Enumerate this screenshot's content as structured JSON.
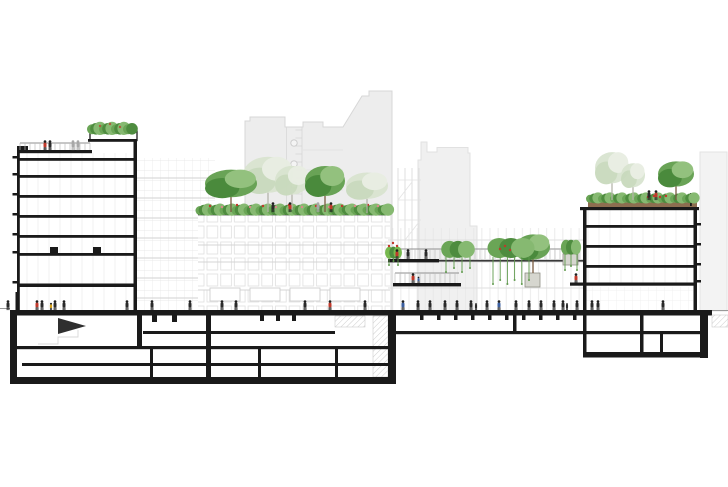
{
  "colors": {
    "ink": "#1a1a1a",
    "ground_line": "#9a9a9a",
    "sil_fill": "#ededed",
    "sil_edge": "#d7d7d7",
    "sil_fill2": "#f0f0f0",
    "tree_mid": "#69a356",
    "tree_dark": "#4a8a3c",
    "tree_light": "#93c17e",
    "faint_mid": "#d9e4d0",
    "faint_dark": "#c9dabd",
    "faint_light": "#e8eee2",
    "trunk": "#7a5a40",
    "trunk_faint": "#b3b3a8",
    "shrub1": "#6aa556",
    "shrub2": "#4e8c3f",
    "shrub3": "#86b971",
    "bright": "#76b94e",
    "soil": "#8d6e50",
    "soil_dark": "#5f4632",
    "red": "#c0392b",
    "pink": "#d98a8a",
    "rust": "#b05a3c",
    "person_dark": "#2a2a2a",
    "person_gray": "#a8a8a8",
    "blue": "#3b5fa0",
    "yellow": "#d4a017",
    "pot": "#d6d6cf",
    "pot_edge": "#8f8f85",
    "rail": "#bcbcbc",
    "rail_dark": "#8f8f8f",
    "grid_dark": "#d2d2d2",
    "vine": "#5f9a4c"
  },
  "silhouettes": {
    "central": {
      "points": "245,311 245,121 250,121 250,117 285,117 285,127 303,127 303,122 323,122 323,127 343,127 362,96 369,96 369,91 392,91 392,311",
      "verticals": [
        286.5,
        302
      ],
      "ladder_x": [
        295.5,
        302
      ],
      "ladder_y1": 130,
      "ladder_y2": 196,
      "ladder_step": 8,
      "circles": {
        "cx": 294,
        "cys": [
          143,
          164,
          185
        ],
        "r": 3.2
      },
      "hlines": {
        "x1": 303,
        "x2": 343,
        "ys": [
          150,
          170,
          190
        ]
      }
    },
    "rightbg": {
      "points": "418,311 418,160 421,160 421,142 427,142 427,152 437,152 437,147.5 468,147.5 468,153 470,153 470,226 477,226 477,311"
    },
    "farright": {
      "points": "700,311 700,152 727,152 727,311"
    },
    "trellis": {
      "verticals": [
        398,
        405,
        412,
        419
      ],
      "y1": 168,
      "y2": 262,
      "hlines": [
        180,
        200,
        220,
        240
      ],
      "hx1": 398,
      "hx2": 421,
      "diagonals": [
        [
          398,
          200,
          412,
          182
        ],
        [
          405,
          240,
          419,
          222
        ]
      ]
    }
  },
  "back_facade": {
    "rect": [
      137,
      158,
      78,
      153
    ],
    "floor_ys": [
      178,
      198,
      218,
      238,
      258,
      278,
      298
    ]
  },
  "podium": {
    "deck": [
      198,
      212.5,
      192,
      2.8
    ],
    "facade": [
      198,
      214,
      192,
      97
    ],
    "floor_lines": [
      245,
      262,
      290
    ],
    "storefronts": [
      [
        210,
        288,
        30,
        13
      ],
      [
        250,
        288,
        30,
        13
      ],
      [
        290,
        288,
        30,
        13
      ],
      [
        330,
        288,
        30,
        13
      ]
    ]
  },
  "colonnade": {
    "rect": [
      388,
      228,
      195,
      82
    ],
    "lines": [
      240,
      262,
      288
    ]
  },
  "decks": {
    "a_black": [
      388,
      259,
      51,
      3.4
    ],
    "a_thin": [
      439,
      259.8,
      144,
      1.8
    ],
    "a_rail": [
      390,
      580,
      249,
      259
    ],
    "b_black": [
      393,
      283,
      68,
      3.4
    ],
    "b_rail": [
      395,
      459,
      273,
      283
    ]
  },
  "left_building": {
    "wallL": [
      17,
      150,
      2.8,
      160
    ],
    "wallR": [
      133.5,
      140,
      3.5,
      170
    ],
    "roof_slab": [
      17,
      150,
      75,
      3.2
    ],
    "parapet": [
      17,
      146,
      11,
      4
    ],
    "interior": [
      19,
      153,
      114.5,
      157
    ],
    "floors": [
      [
        19,
        158,
        115,
        2.8
      ],
      [
        19,
        175,
        115,
        2.8
      ],
      [
        19,
        195,
        115,
        2.8
      ],
      [
        19,
        215,
        115,
        2.8
      ],
      [
        19,
        235,
        115,
        2.8
      ],
      [
        19,
        253,
        115,
        2.8
      ],
      [
        19,
        283.5,
        115,
        3.5
      ]
    ],
    "ticks_y": [
      156,
      173,
      193,
      213,
      233,
      251,
      281
    ],
    "planter_box": [
      90,
      131,
      47,
      9.5
    ],
    "planter_slab": [
      88,
      139,
      49,
      2.8
    ],
    "doors": [
      [
        50,
        247,
        8,
        6
      ],
      [
        93,
        247,
        8,
        6
      ]
    ],
    "roof_rail": [
      20,
      90,
      143,
      150
    ]
  },
  "right_building": {
    "wallL": [
      583,
      207,
      3.5,
      103
    ],
    "wallR": [
      693.5,
      207,
      3.5,
      103
    ],
    "roof_slab": [
      580,
      207,
      119,
      3.2
    ],
    "soil": [
      588,
      200,
      109,
      7
    ],
    "rail_post": [
      690,
      193,
      1.8,
      13
    ],
    "interior": [
      586,
      210,
      107,
      73
    ],
    "ground_floor": [
      586,
      287,
      107,
      23
    ],
    "floors": [
      [
        586,
        225,
        108,
        2.8
      ],
      [
        586,
        245,
        108,
        2.8
      ],
      [
        586,
        265,
        108,
        2.8
      ],
      [
        570,
        282.5,
        124,
        3.2
      ]
    ],
    "ticks_y": [
      223,
      243,
      263,
      280
    ]
  },
  "trees": {
    "podium": [
      {
        "x": 268,
        "y": 212,
        "w": 50,
        "h": 60,
        "kind": "faint"
      },
      {
        "x": 292,
        "y": 210,
        "w": 34,
        "h": 48,
        "kind": "faint"
      },
      {
        "x": 367,
        "y": 213,
        "w": 42,
        "h": 44,
        "kind": "faint"
      },
      {
        "x": 231,
        "y": 212,
        "w": 52,
        "h": 46,
        "kind": "solid"
      },
      {
        "x": 325,
        "y": 212,
        "w": 40,
        "h": 50,
        "kind": "solid"
      }
    ],
    "right_roof": [
      {
        "x": 612,
        "y": 200,
        "w": 34,
        "h": 52,
        "kind": "faint"
      },
      {
        "x": 633,
        "y": 200,
        "w": 24,
        "h": 40,
        "kind": "faint"
      },
      {
        "x": 676,
        "y": 200,
        "w": 36,
        "h": 42,
        "kind": "solid"
      }
    ]
  },
  "shrub_bands": [
    {
      "x1": 200,
      "x2": 388,
      "y": 213,
      "h": 9
    },
    {
      "x1": 342,
      "x2": 386,
      "y": 212,
      "h": 7
    },
    {
      "x1": 92,
      "x2": 135,
      "y": 132,
      "h": 10
    },
    {
      "x1": 590,
      "x2": 694,
      "y": 201,
      "h": 8
    }
  ],
  "flowers": [
    {
      "c": "red",
      "points": [
        [
          210,
          206
        ],
        [
          237,
          205
        ],
        [
          263,
          206
        ],
        [
          289,
          205
        ],
        [
          316,
          206
        ],
        [
          342,
          206
        ],
        [
          368,
          205
        ]
      ]
    },
    {
      "c": "pink",
      "points": [
        [
          222,
          207
        ],
        [
          250,
          207
        ],
        [
          276,
          207
        ],
        [
          302,
          207
        ],
        [
          329,
          207
        ],
        [
          355,
          206
        ],
        [
          378,
          206
        ]
      ]
    },
    {
      "c": "red",
      "points": [
        [
          648,
          197
        ],
        [
          654,
          196
        ],
        [
          660,
          197
        ],
        [
          666,
          196
        ]
      ]
    },
    {
      "c": "rust",
      "points": [
        [
          100,
          126
        ],
        [
          110,
          124
        ],
        [
          120,
          127
        ]
      ]
    },
    {
      "c": "red",
      "points": [
        [
          389,
          246
        ],
        [
          393,
          243
        ],
        [
          397,
          246
        ]
      ]
    },
    {
      "c": "red",
      "points": [
        [
          500,
          249
        ],
        [
          505,
          246
        ],
        [
          510,
          250
        ]
      ]
    }
  ],
  "planters": [
    {
      "x": 386,
      "w": 15,
      "base": 258,
      "h": 12,
      "vinesTo": 265,
      "bright": true
    },
    {
      "x": 443,
      "w": 30,
      "base": 257,
      "h": 17,
      "vinesTo": 272
    },
    {
      "x": 490,
      "w": 42,
      "base": 257,
      "h": 20,
      "vinesTo": 284,
      "pot": [
        525,
        273,
        15,
        14
      ],
      "tree": {
        "x": 533,
        "y": 273,
        "w": 34,
        "h": 42,
        "kind": "solid"
      }
    },
    {
      "x": 562,
      "w": 18,
      "base": 254,
      "h": 15,
      "vinesTo": 270,
      "pot": [
        563,
        254,
        15,
        11
      ]
    }
  ],
  "people": {
    "ground_y": 310,
    "ground": [
      {
        "x": 8,
        "c": "dark"
      },
      {
        "x": 37,
        "c": "red"
      },
      {
        "x": 42,
        "c": "dark"
      },
      {
        "x": 51,
        "c": "yellow",
        "s": 0.75
      },
      {
        "x": 55,
        "c": "dark"
      },
      {
        "x": 64,
        "c": "dark"
      },
      {
        "x": 127,
        "c": "dark"
      },
      {
        "x": 152,
        "c": "dark"
      },
      {
        "x": 190,
        "c": "dark"
      },
      {
        "x": 222,
        "c": "dark"
      },
      {
        "x": 236,
        "c": "dark"
      },
      {
        "x": 305,
        "c": "dark"
      },
      {
        "x": 330,
        "c": "red"
      },
      {
        "x": 365,
        "c": "dark"
      },
      {
        "x": 403,
        "c": "blue"
      },
      {
        "x": 418,
        "c": "dark"
      },
      {
        "x": 430,
        "c": "dark"
      },
      {
        "x": 445,
        "c": "dark"
      },
      {
        "x": 457,
        "c": "dark"
      },
      {
        "x": 471,
        "c": "dark"
      },
      {
        "x": 476,
        "c": "dark",
        "s": 0.7
      },
      {
        "x": 487,
        "c": "dark"
      },
      {
        "x": 499,
        "c": "blue"
      },
      {
        "x": 516,
        "c": "dark"
      },
      {
        "x": 529,
        "c": "dark"
      },
      {
        "x": 541,
        "c": "dark"
      },
      {
        "x": 554,
        "c": "dark"
      },
      {
        "x": 563,
        "c": "dark"
      },
      {
        "x": 567,
        "c": "dark",
        "s": 0.7
      },
      {
        "x": 577,
        "c": "dark"
      },
      {
        "x": 592,
        "c": "dark"
      },
      {
        "x": 598,
        "c": "dark"
      },
      {
        "x": 663,
        "c": "dark"
      }
    ],
    "left_roof_y": 150,
    "left_roof": [
      {
        "x": 45,
        "c": "red"
      },
      {
        "x": 50,
        "c": "dark"
      },
      {
        "x": 73,
        "c": "gray"
      },
      {
        "x": 78,
        "c": "gray"
      }
    ],
    "podium_y": 212,
    "podium": [
      {
        "x": 273,
        "c": "dark"
      },
      {
        "x": 290,
        "c": "red"
      },
      {
        "x": 318,
        "c": "gray"
      },
      {
        "x": 331,
        "c": "red"
      }
    ],
    "deckA_y": 259,
    "deckA": [
      {
        "x": 397,
        "c": "red"
      },
      {
        "x": 408,
        "c": "dark"
      },
      {
        "x": 426,
        "c": "dark"
      }
    ],
    "deckB_y": 283,
    "deckB": [
      {
        "x": 413,
        "c": "red"
      },
      {
        "x": 418.5,
        "c": "blue",
        "s": 0.65
      }
    ],
    "right_roof_y": 200,
    "right_roof": [
      {
        "x": 649,
        "c": "dark"
      },
      {
        "x": 656,
        "c": "red"
      }
    ],
    "balcony_y": 283,
    "balcony": [
      {
        "x": 576,
        "c": "red"
      }
    ]
  },
  "ground": {
    "slab": [
      10,
      310,
      702,
      5.5
    ],
    "lines": [
      [
        0,
        10,
        308.5
      ],
      [
        712,
        728,
        310.5
      ]
    ],
    "post": [
      15.5,
      292,
      2.2,
      18
    ]
  },
  "basement": {
    "black": [
      [
        10,
        310,
        7,
        74
      ],
      [
        10,
        377,
        386,
        7
      ],
      [
        388,
        310,
        8,
        74
      ],
      [
        17,
        346,
        371,
        3.2
      ],
      [
        22,
        363,
        366,
        3
      ],
      [
        137,
        315,
        5,
        31
      ],
      [
        143,
        331,
        192,
        3
      ],
      [
        206,
        310,
        5,
        67
      ],
      [
        150,
        349,
        3,
        28
      ],
      [
        258,
        349,
        3,
        28
      ],
      [
        335,
        349,
        3,
        28
      ],
      [
        152,
        315,
        5,
        7
      ],
      [
        172,
        315,
        5,
        7
      ],
      [
        260,
        315,
        4,
        6
      ],
      [
        276,
        315,
        4,
        6
      ],
      [
        292,
        315,
        4,
        6
      ],
      [
        396,
        331,
        311,
        3.2
      ],
      [
        513,
        315,
        3.5,
        19
      ],
      [
        583,
        315,
        3.5,
        40
      ],
      [
        640,
        315,
        3.5,
        40
      ],
      [
        660,
        334,
        3,
        18
      ],
      [
        700,
        313,
        8,
        45
      ],
      [
        583,
        352,
        125,
        5.5
      ],
      [
        420,
        315,
        3.5,
        5
      ],
      [
        437,
        315,
        3.5,
        5
      ],
      [
        454,
        315,
        3.5,
        5
      ],
      [
        471,
        315,
        3.5,
        5
      ],
      [
        488,
        315,
        3.5,
        5
      ],
      [
        505,
        315,
        3.5,
        5
      ],
      [
        522,
        315,
        3.5,
        5
      ],
      [
        539,
        315,
        3.5,
        5
      ],
      [
        556,
        315,
        3.5,
        5
      ],
      [
        573,
        315,
        3.5,
        5
      ]
    ],
    "hatch": [
      [
        373,
        316,
        15,
        61
      ],
      [
        335,
        316,
        30,
        11
      ],
      [
        712,
        315,
        16,
        12
      ]
    ],
    "stair_triangle": "58,318 86,326 58,334",
    "stair_lines": "38,344 58,344 58,337 78,337 78,330"
  }
}
